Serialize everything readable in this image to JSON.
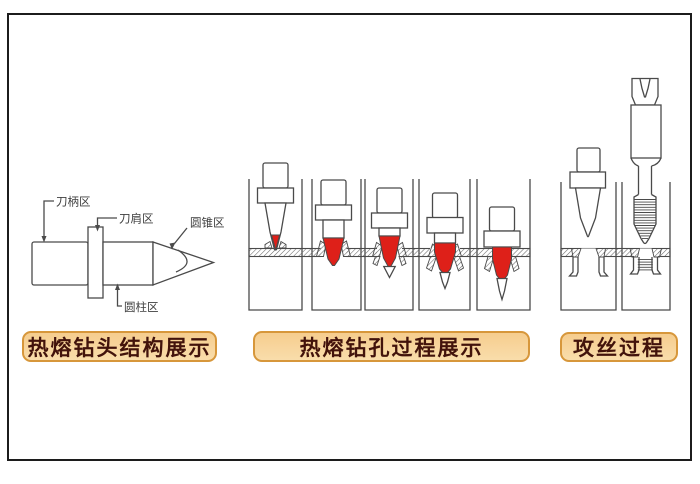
{
  "figure": {
    "left": {
      "caption": "热熔钻头结构展示",
      "labels": {
        "shank": "刀柄区",
        "shoulder": "刀肩区",
        "cone": "圆锥区",
        "cylinder": "圆柱区"
      }
    },
    "middle": {
      "caption": "热熔钻孔过程展示",
      "stage_count": "5"
    },
    "right": {
      "caption": "攻丝过程"
    }
  },
  "colors": {
    "heat_red": "#de2019",
    "line": "#4a4a4a",
    "caption_bg_top": "#f6cd8e",
    "caption_bg_bottom": "#f9ddab",
    "caption_border": "#d7973b",
    "caption_text": "#42130b",
    "frame": "#1c1c1c",
    "background": "#ffffff"
  }
}
